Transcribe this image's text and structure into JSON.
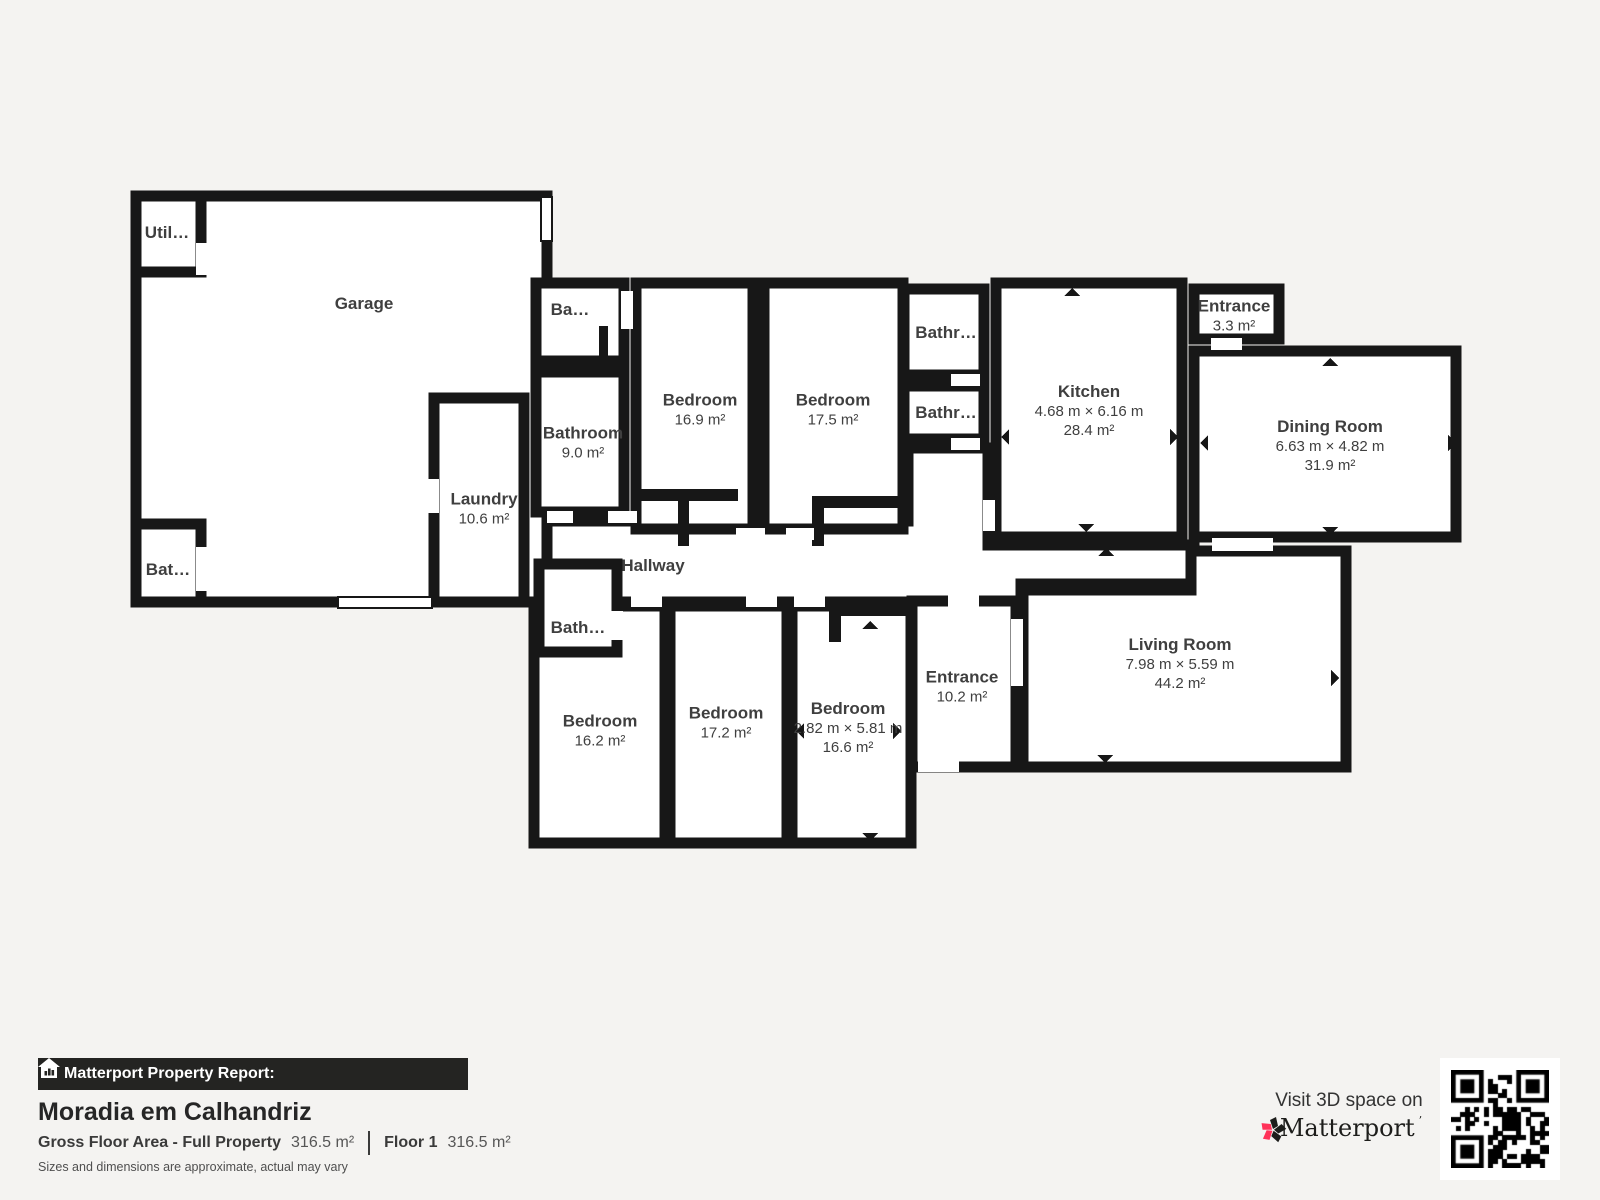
{
  "plan": {
    "rooms": {
      "garage": {
        "label": "Garage"
      },
      "utility": {
        "label": "Util…"
      },
      "bath_garage": {
        "label": "Bat…"
      },
      "laundry": {
        "label": "Laundry",
        "area": "10.6 m²"
      },
      "bath_top": {
        "label": "Ba…"
      },
      "bathroom_9": {
        "label": "Bathroom",
        "area": "9.0 m²"
      },
      "bedroom_169": {
        "label": "Bedroom",
        "area": "16.9 m²"
      },
      "bedroom_175": {
        "label": "Bedroom",
        "area": "17.5 m²"
      },
      "bathroom_r1": {
        "label": "Bathr…"
      },
      "bathroom_r2": {
        "label": "Bathr…"
      },
      "kitchen": {
        "label": "Kitchen",
        "dims": "4.68 m × 6.16 m",
        "area": "28.4 m²"
      },
      "entrance_small": {
        "label": "Entrance",
        "area": "3.3 m²"
      },
      "dining": {
        "label": "Dining Room",
        "dims": "6.63 m × 4.82 m",
        "area": "31.9 m²"
      },
      "hallway": {
        "label": "Hallway"
      },
      "bath_hall": {
        "label": "Bath…"
      },
      "bedroom_162": {
        "label": "Bedroom",
        "area": "16.2 m²"
      },
      "bedroom_172": {
        "label": "Bedroom",
        "area": "17.2 m²"
      },
      "bedroom_166": {
        "label": "Bedroom",
        "dims": "2.82 m × 5.81 m",
        "area": "16.6 m²"
      },
      "entrance_main": {
        "label": "Entrance",
        "area": "10.2 m²"
      },
      "living": {
        "label": "Living Room",
        "dims": "7.98 m × 5.59 m",
        "area": "44.2 m²"
      }
    }
  },
  "report": {
    "bar_label": "Matterport Property Report:",
    "title": "Moradia em Calhandriz",
    "gfa_label": "Gross Floor Area - Full Property",
    "gfa_value": "316.5 m²",
    "floor_label": "Floor 1",
    "floor_value": "316.5 m²",
    "disclaimer": "Sizes and dimensions are approximate, actual may vary"
  },
  "cta": {
    "visit_label": "Visit 3D space on",
    "brand": "Matterport",
    "brand_mark": "’",
    "qr_icon": "qr-code"
  },
  "colors": {
    "background": "#f4f3f1",
    "wall": "#171717",
    "room_fill": "#ffffff",
    "label_text": "#3f3f3f",
    "accent_pink": "#ff3158",
    "bar_background": "#242422"
  }
}
